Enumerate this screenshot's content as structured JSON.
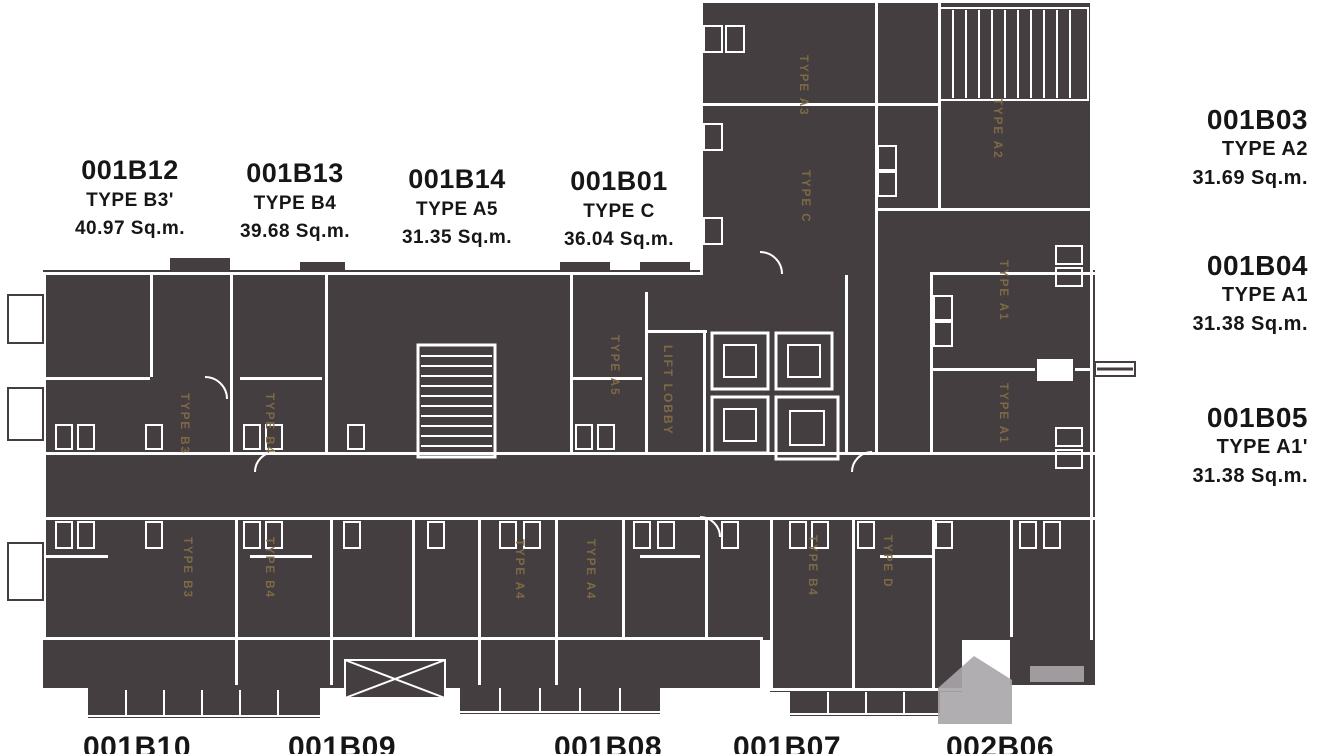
{
  "units_top": [
    {
      "id": "001B12",
      "type": "TYPE B3'",
      "area": "40.97 Sq.m."
    },
    {
      "id": "001B13",
      "type": "TYPE B4",
      "area": "39.68 Sq.m."
    },
    {
      "id": "001B14",
      "type": "TYPE A5",
      "area": "31.35 Sq.m."
    },
    {
      "id": "001B01",
      "type": "TYPE C",
      "area": "36.04 Sq.m."
    }
  ],
  "units_right": [
    {
      "id": "001B03",
      "type": "TYPE A2",
      "area": "31.69 Sq.m."
    },
    {
      "id": "001B04",
      "type": "TYPE A1",
      "area": "31.38 Sq.m."
    },
    {
      "id": "001B05",
      "type": "TYPE A1'",
      "area": "31.38 Sq.m."
    }
  ],
  "units_bottom": [
    {
      "id": "001B10"
    },
    {
      "id": "001B09"
    },
    {
      "id": "001B08"
    },
    {
      "id": "001B07"
    },
    {
      "id": "002B06"
    }
  ],
  "plan": {
    "labels": [
      {
        "text": "TYPE B3"
      },
      {
        "text": "TYPE B4"
      },
      {
        "text": "TYPE A5"
      },
      {
        "text": "LIFT LOBBY"
      },
      {
        "text": "TYPE A3"
      },
      {
        "text": "TYPE C"
      },
      {
        "text": "TYPE A2"
      },
      {
        "text": "TYPE A1"
      },
      {
        "text": "TYPE A1"
      },
      {
        "text": "TYPE B3"
      },
      {
        "text": "TYPE B4"
      },
      {
        "text": "TYPE A4"
      },
      {
        "text": "TYPE A4"
      },
      {
        "text": "TYPE B4"
      },
      {
        "text": "TYPE D"
      }
    ]
  },
  "colors": {
    "plan_dark": "#453e41",
    "wall_white": "#ffffff",
    "label_gold": "#806d46",
    "outside_text": "#161616",
    "watermark_gray": "#a8a5a8"
  }
}
